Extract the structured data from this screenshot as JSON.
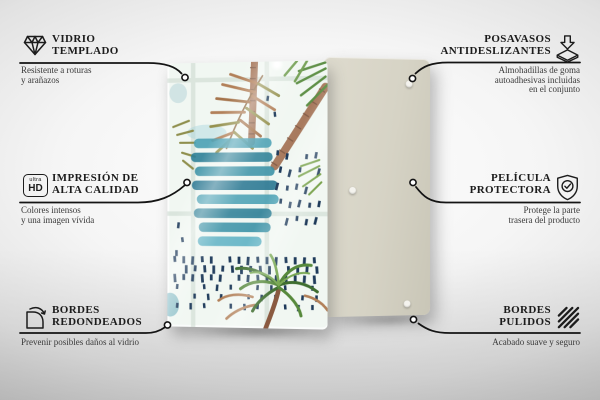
{
  "features": {
    "left": [
      {
        "icon": "diamond-icon",
        "title": [
          "VIDRIO",
          "TEMPLADO"
        ],
        "desc": [
          "Resistente a roturas",
          "y arañazos"
        ]
      },
      {
        "icon": "ultra-hd-icon",
        "title": [
          "IMPRESIÓN DE",
          "ALTA CALIDAD"
        ],
        "desc": [
          "Colores intensos",
          "y una imagen vívida"
        ]
      },
      {
        "icon": "rounded-corner-icon",
        "title": [
          "BORDES",
          "REDONDEADOS"
        ],
        "desc": [
          "Prevenir posibles daños al vidrio"
        ]
      }
    ],
    "right": [
      {
        "icon": "anti-slip-pad-icon",
        "title": [
          "POSAVASOS",
          "ANTIDESLIZANTES"
        ],
        "desc": [
          "Almohadillas de goma",
          "autoadhesivas incluidas",
          "en el conjunto"
        ]
      },
      {
        "icon": "shield-check-icon",
        "title": [
          "PELÍCULA",
          "PROTECTORA"
        ],
        "desc": [
          "Protege la parte",
          "trasera del producto"
        ]
      },
      {
        "icon": "polished-edges-icon",
        "title": [
          "BORDES",
          "PULIDOS"
        ],
        "desc": [
          "Acabado suave y seguro"
        ]
      }
    ]
  },
  "ultra_hd_badge": {
    "top": "ultra",
    "bottom": "HD"
  },
  "colors": {
    "line": "#141414",
    "title_text": "#1c1c1c",
    "desc_text": "#3a3a3a",
    "back_panel": "#d6d3c5",
    "artwork_teal": "#3b91a6",
    "artwork_navy": "#1e3a5a",
    "artwork_green": "#57893c",
    "artwork_rust": "#b28059"
  }
}
